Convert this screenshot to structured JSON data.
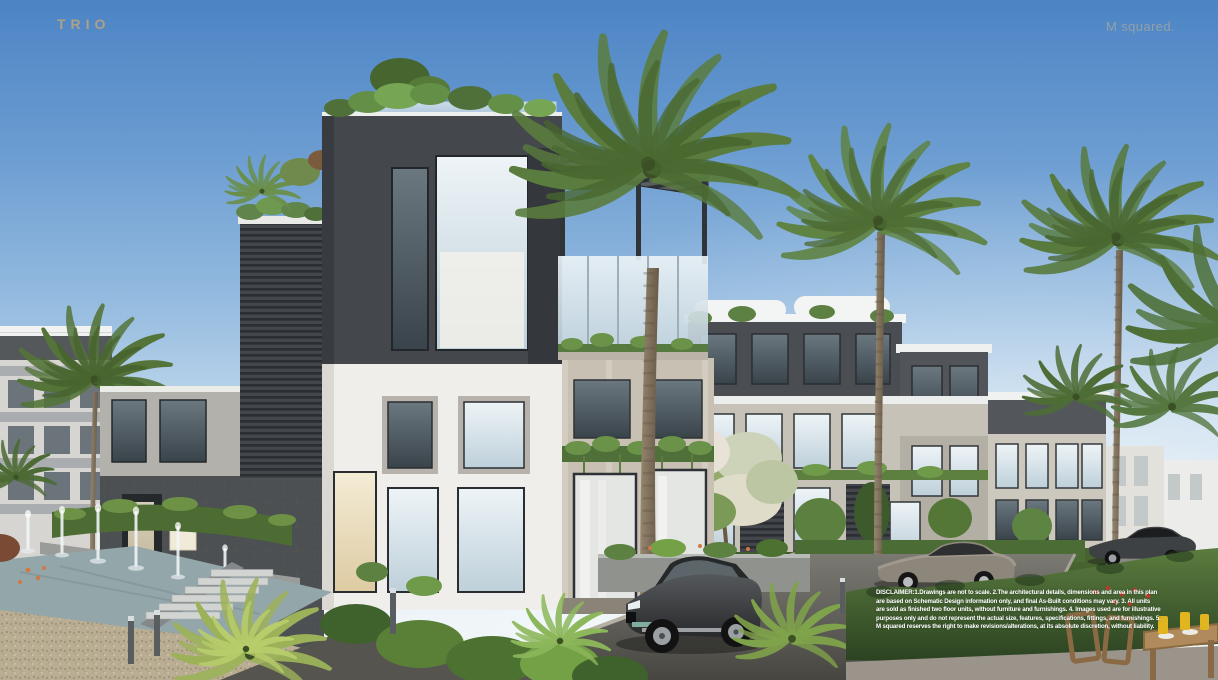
{
  "header": {
    "logo_text": "TRIO",
    "brand_text": "M squared."
  },
  "footer": {
    "disclaimer_lines": [
      "DISCLAIMER:1.Drawings are not to scale. 2.The architectural details, dimensions and area in this plan",
      "are based on Schematic Design information only, and final As-Built conditions may vary. 3. All units",
      "are sold as finished two floor units, without furniture and furnishings. 4. Images used are for illustrative",
      "purposes only and do not represent the actual size, features, specifications, fittings, and furnishings. 5.",
      "M squared reserves the right to make revisions/alterations, at its absolute discretion, without liability."
    ]
  },
  "colors": {
    "logo": "#b3a286",
    "brand": "#93a0aa",
    "disclaimer_text": "#ffffff",
    "sky_top": "#4c84c4",
    "sky_horizon": "#eff5f8",
    "building_charcoal": "#44474b",
    "building_white": "#f0eeea",
    "building_stone": "#c7c0b3",
    "foliage_green": "#5d8140",
    "hedge_green": "#2f4724",
    "asphalt": "#494844",
    "gravel": "#b9ad94",
    "water": "#93a6aa",
    "suv_body": "#3a3d3f"
  },
  "scene": {
    "description": "Architectural rendering: modern charcoal, white and stone residential buildings with rooftop gardens and pergola, palm trees, fountain water feature with jets, landscaped road with dark SUV and two parked sedans, hedges, and an outdoor wooden dining set."
  }
}
